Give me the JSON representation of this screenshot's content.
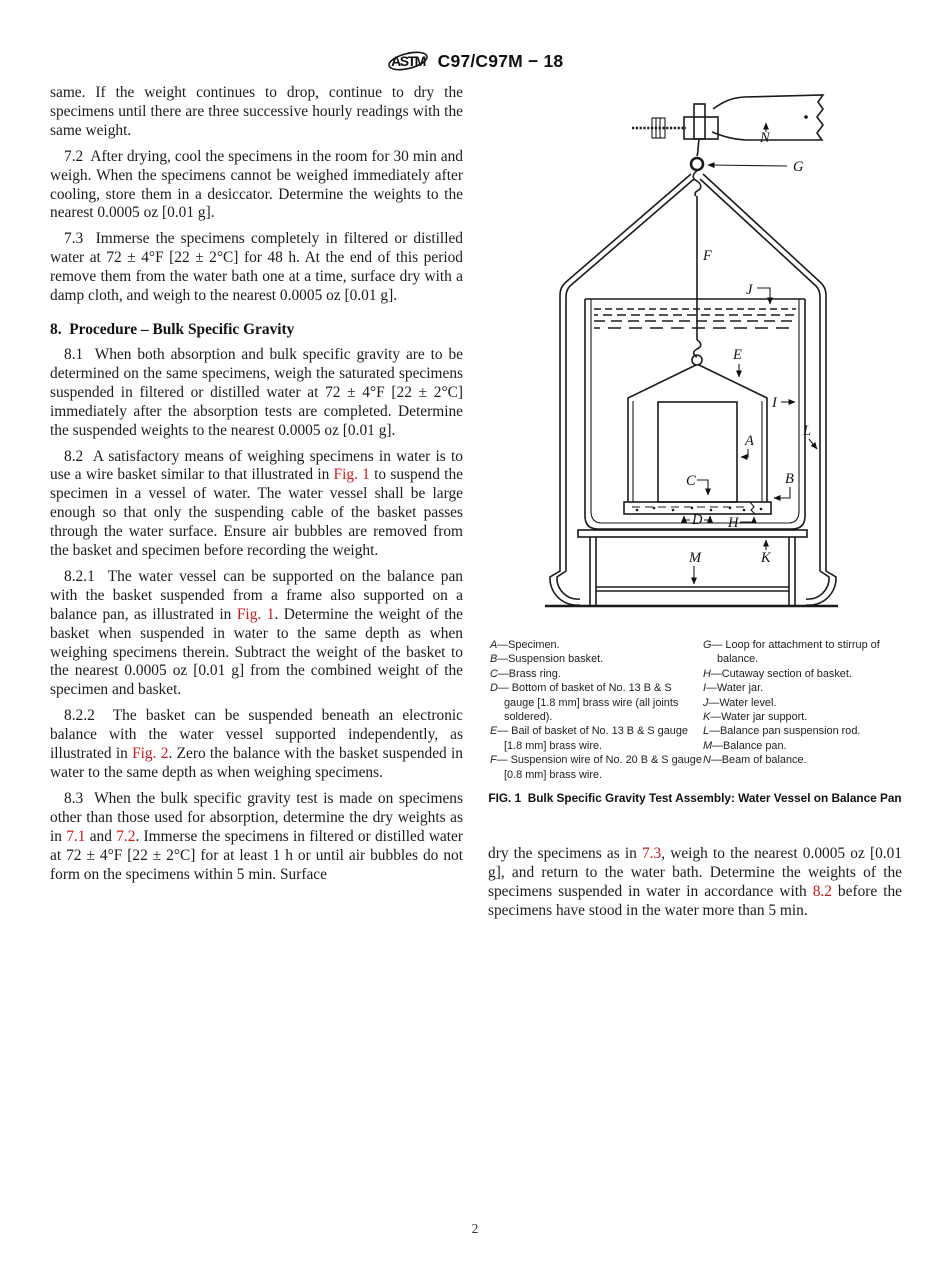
{
  "header": {
    "title": "C97/C97M − 18",
    "logo_text": "ASTM"
  },
  "page_number": "2",
  "colors": {
    "link_red": "#c61a1b",
    "ink": "#1c1c1c"
  },
  "left_column": {
    "blocks": [
      {
        "type": "p",
        "indent": false,
        "segments": [
          {
            "t": "same. If the weight continues to drop, continue to dry the specimens until there are three successive hourly readings with the same weight."
          }
        ]
      },
      {
        "type": "p",
        "indent": true,
        "segments": [
          {
            "t": "7.2  After drying, cool the specimens in the room for 30 min and weigh. When the specimens cannot be weighed immediately after cooling, store them in a desiccator. Determine the weights to the nearest 0.0005 oz [0.01 g]."
          }
        ]
      },
      {
        "type": "p",
        "indent": true,
        "segments": [
          {
            "t": "7.3  Immerse the specimens completely in filtered or distilled water at 72 ± 4°F [22 ± 2°C] for 48 h. At the end of this period remove them from the water bath one at a time, surface dry with a damp cloth, and weigh to the nearest 0.0005 oz [0.01 g]."
          }
        ]
      },
      {
        "type": "h",
        "text": "8.  Procedure – Bulk Specific Gravity"
      },
      {
        "type": "p",
        "indent": true,
        "segments": [
          {
            "t": "8.1  When both absorption and bulk specific gravity are to be determined on the same specimens, weigh the saturated specimens suspended in filtered or distilled water at 72 ± 4°F [22 ± 2°C] immediately after the absorption tests are completed. Determine the suspended weights to the nearest 0.0005 oz [0.01 g]."
          }
        ]
      },
      {
        "type": "p",
        "indent": true,
        "segments": [
          {
            "t": "8.2  A satisfactory means of weighing specimens in water is to use a wire basket similar to that illustrated in "
          },
          {
            "t": "Fig. 1",
            "link": true
          },
          {
            "t": " to suspend the specimen in a vessel of water. The water vessel shall be large enough so that only the suspending cable of the basket passes through the water surface. Ensure air bubbles are removed from the basket and specimen before recording the weight."
          }
        ]
      },
      {
        "type": "p",
        "indent": true,
        "segments": [
          {
            "t": "8.2.1  The water vessel can be supported on the balance pan with the basket suspended from a frame also supported on a balance pan, as illustrated in "
          },
          {
            "t": "Fig. 1",
            "link": true
          },
          {
            "t": ". Determine the weight of the basket when suspended in water to the same depth as when weighing specimens therein. Subtract the weight of the basket to the nearest 0.0005 oz [0.01 g] from the combined weight of the specimen and basket."
          }
        ]
      },
      {
        "type": "p",
        "indent": true,
        "segments": [
          {
            "t": "8.2.2  The basket can be suspended beneath an electronic balance with the water vessel supported independently, as illustrated in "
          },
          {
            "t": "Fig. 2",
            "link": true
          },
          {
            "t": ". Zero the balance with the basket suspended in water to the same depth as when weighing specimens."
          }
        ]
      },
      {
        "type": "p",
        "indent": true,
        "segments": [
          {
            "t": "8.3  When the bulk specific gravity test is made on specimens other than those used for absorption, determine the dry weights as in "
          },
          {
            "t": "7.1",
            "link": true
          },
          {
            "t": " and "
          },
          {
            "t": "7.2",
            "link": true
          },
          {
            "t": ". Immerse the specimens in filtered or distilled water at 72 ± 4°F [22 ± 2°C] for at least 1 h or until air bubbles do not form on the specimens within 5 min. Surface"
          }
        ]
      }
    ]
  },
  "right_column": {
    "figure": {
      "labels": {
        "A": "A",
        "B": "B",
        "C": "C",
        "D": "D",
        "E": "E",
        "F": "F",
        "G": "G",
        "H": "H",
        "I": "I",
        "J": "J",
        "K": "K",
        "L": "L",
        "M": "M",
        "N": "N"
      }
    },
    "legend_left": [
      {
        "k": "A",
        "t": "—Specimen."
      },
      {
        "k": "B",
        "t": "—Suspension basket."
      },
      {
        "k": "C",
        "t": "—Brass ring."
      },
      {
        "k": "D",
        "t": "— Bottom of basket of No. 13 B & S gauge [1.8 mm] brass wire (all joints soldered)."
      },
      {
        "k": "E",
        "t": "— Bail of basket of No. 13 B & S gauge [1.8 mm] brass wire."
      },
      {
        "k": "F",
        "t": "— Suspension wire of No. 20 B & S gauge [0.8 mm] brass wire."
      }
    ],
    "legend_right": [
      {
        "k": "G",
        "t": "— Loop for attachment to stirrup of balance."
      },
      {
        "k": "H",
        "t": "—Cutaway section of basket."
      },
      {
        "k": "I",
        "t": "—Water jar."
      },
      {
        "k": "J",
        "t": "—Water level."
      },
      {
        "k": "K",
        "t": "—Water jar support."
      },
      {
        "k": "L",
        "t": "—Balance pan suspension rod."
      },
      {
        "k": "M",
        "t": "—Balance pan."
      },
      {
        "k": "N",
        "t": "—Beam of balance."
      }
    ],
    "caption": "FIG. 1  Bulk Specific Gravity Test Assembly: Water Vessel on Balance Pan",
    "paragraph": {
      "segments": [
        {
          "t": "dry the specimens as in "
        },
        {
          "t": "7.3",
          "link": true
        },
        {
          "t": ", weigh to the nearest 0.0005 oz [0.01 g], and return to the water bath. Determine the weights of the specimens suspended in water in accordance with "
        },
        {
          "t": "8.2",
          "link": true
        },
        {
          "t": " before the specimens have stood in the water more than 5 min."
        }
      ]
    }
  }
}
